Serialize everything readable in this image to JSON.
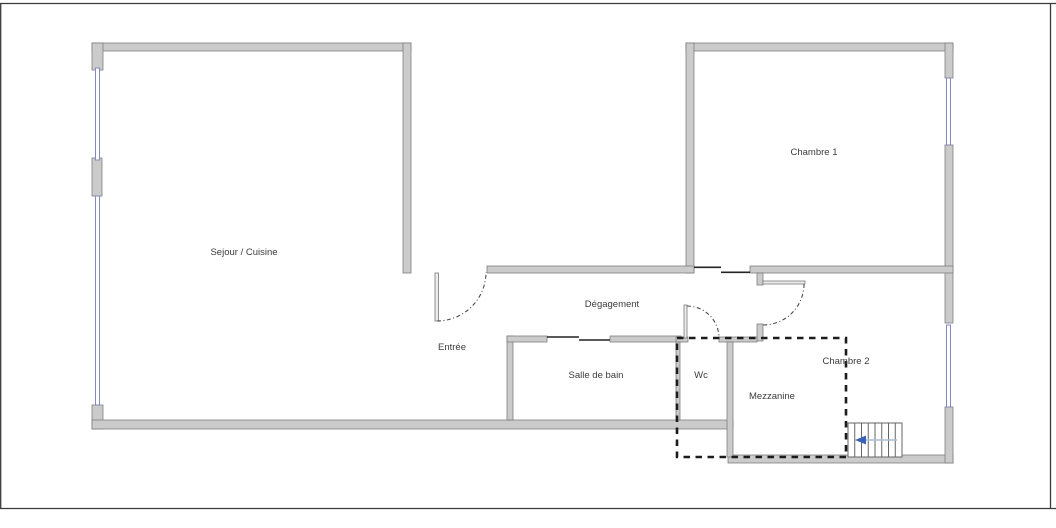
{
  "plan": {
    "rooms": {
      "sejour_cuisine": {
        "label": "Sejour / Cuisine"
      },
      "chambre1": {
        "label": "Chambre 1"
      },
      "degagement": {
        "label": "Dégagement"
      },
      "entree": {
        "label": "Entrée"
      },
      "salle_de_bain": {
        "label": "Salle de bain"
      },
      "wc": {
        "label": "Wc"
      },
      "mezzanine": {
        "label": "Mezzanine"
      },
      "chambre2": {
        "label": "Chambre 2"
      }
    },
    "icons": {
      "stairs_direction_arrow": "left-arrow"
    },
    "colors": {
      "wall_fill": "#cbcbcb",
      "wall_stroke": "#7a7a7a",
      "window_stroke": "#8289bd",
      "dashed": "#1c1c1c",
      "arrow": "#3a62b5",
      "frame": "#3a3a3a",
      "label": "#3c3c3c"
    }
  }
}
